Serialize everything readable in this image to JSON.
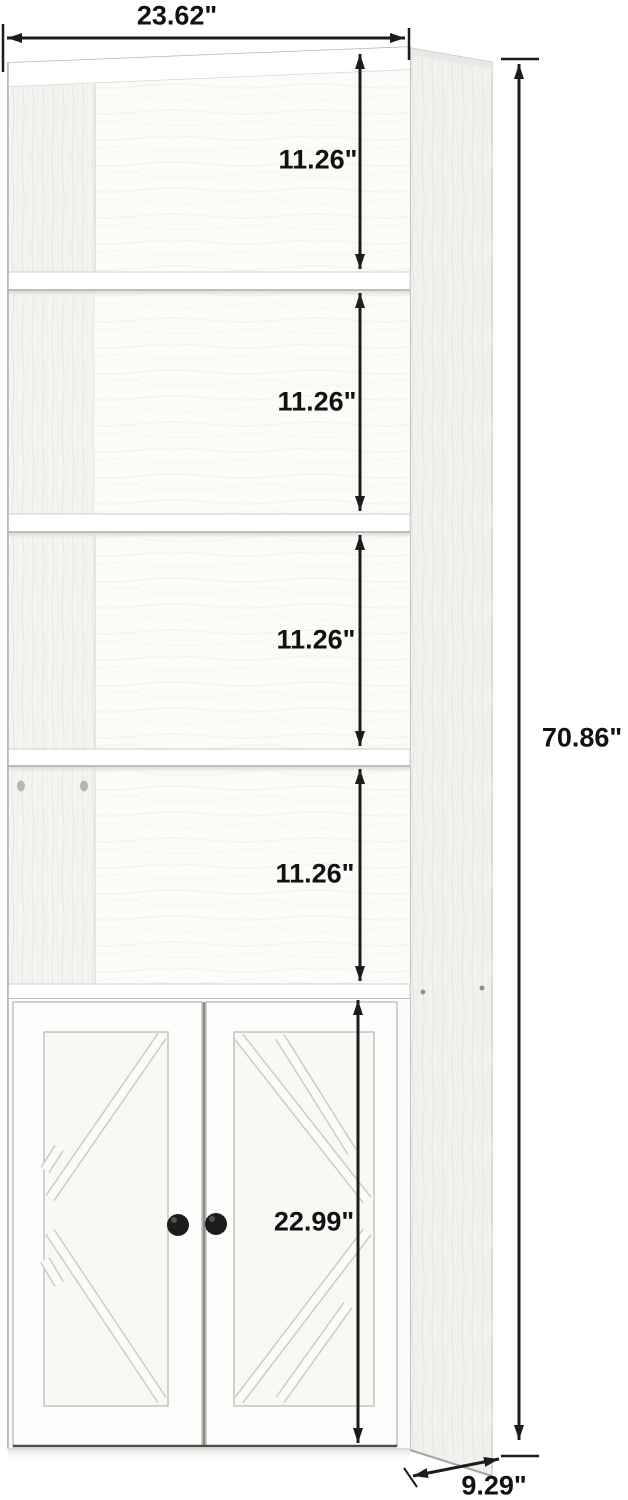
{
  "title": "Bookshelf with cabinet dimension diagram",
  "dimensions": {
    "overall_width": "23.62\"",
    "overall_height": "70.86\"",
    "depth": "9.29\"",
    "shelf_heights": [
      "11.26\"",
      "11.26\"",
      "11.26\"",
      "11.26\""
    ],
    "cabinet_door_height": "22.99\""
  },
  "furniture": {
    "type": "tall bookcase with 4 open shelves and 2-door barn-style cabinet",
    "open_compartments": 4,
    "doors": 2,
    "knobs": 2,
    "finish": "white wood grain"
  },
  "colors": {
    "background": "#ffffff",
    "dimension_line": "#1c1c1c",
    "label_text": "#111111",
    "furniture_white": "#fdfdfc",
    "side_panel_gray": "#f1f1ee",
    "knob_black": "#1c1c1a"
  }
}
